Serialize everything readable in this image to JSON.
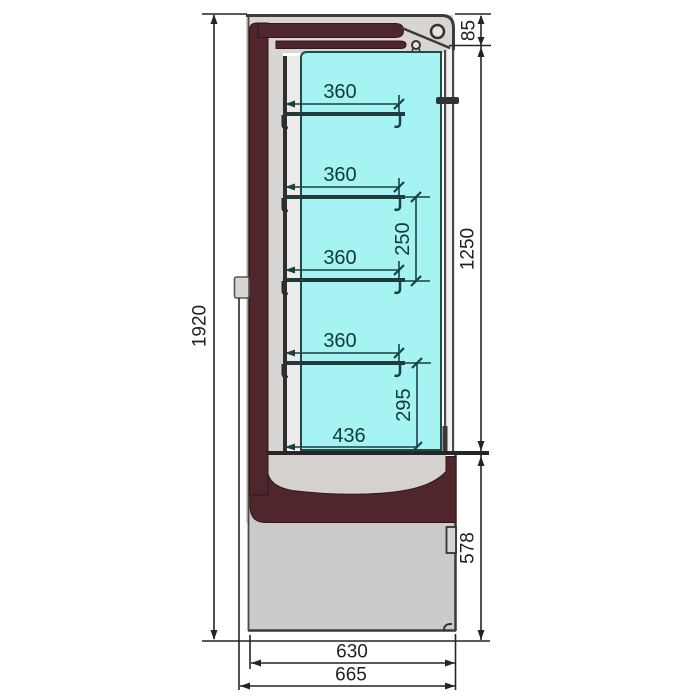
{
  "drawing": {
    "units": "mm",
    "dimensions": {
      "overall_height": "1920",
      "canopy_height": "85",
      "door_section_height": "1250",
      "base_section_height": "578",
      "base_depth": "630",
      "overall_depth": "665",
      "shelf_depths": [
        "360",
        "360",
        "360",
        "360"
      ],
      "shelf_gap": "250",
      "lower_gap": "295",
      "bottom_shelf_depth": "436"
    },
    "colors": {
      "interior_cyan": "#a5f3f3",
      "frame_maroon": "#4e262c",
      "panel_gray": "#d9d5d2",
      "base_gray": "#cccbca",
      "outer_dimension": "#242424",
      "interior_dimension": "#1a4242"
    }
  }
}
